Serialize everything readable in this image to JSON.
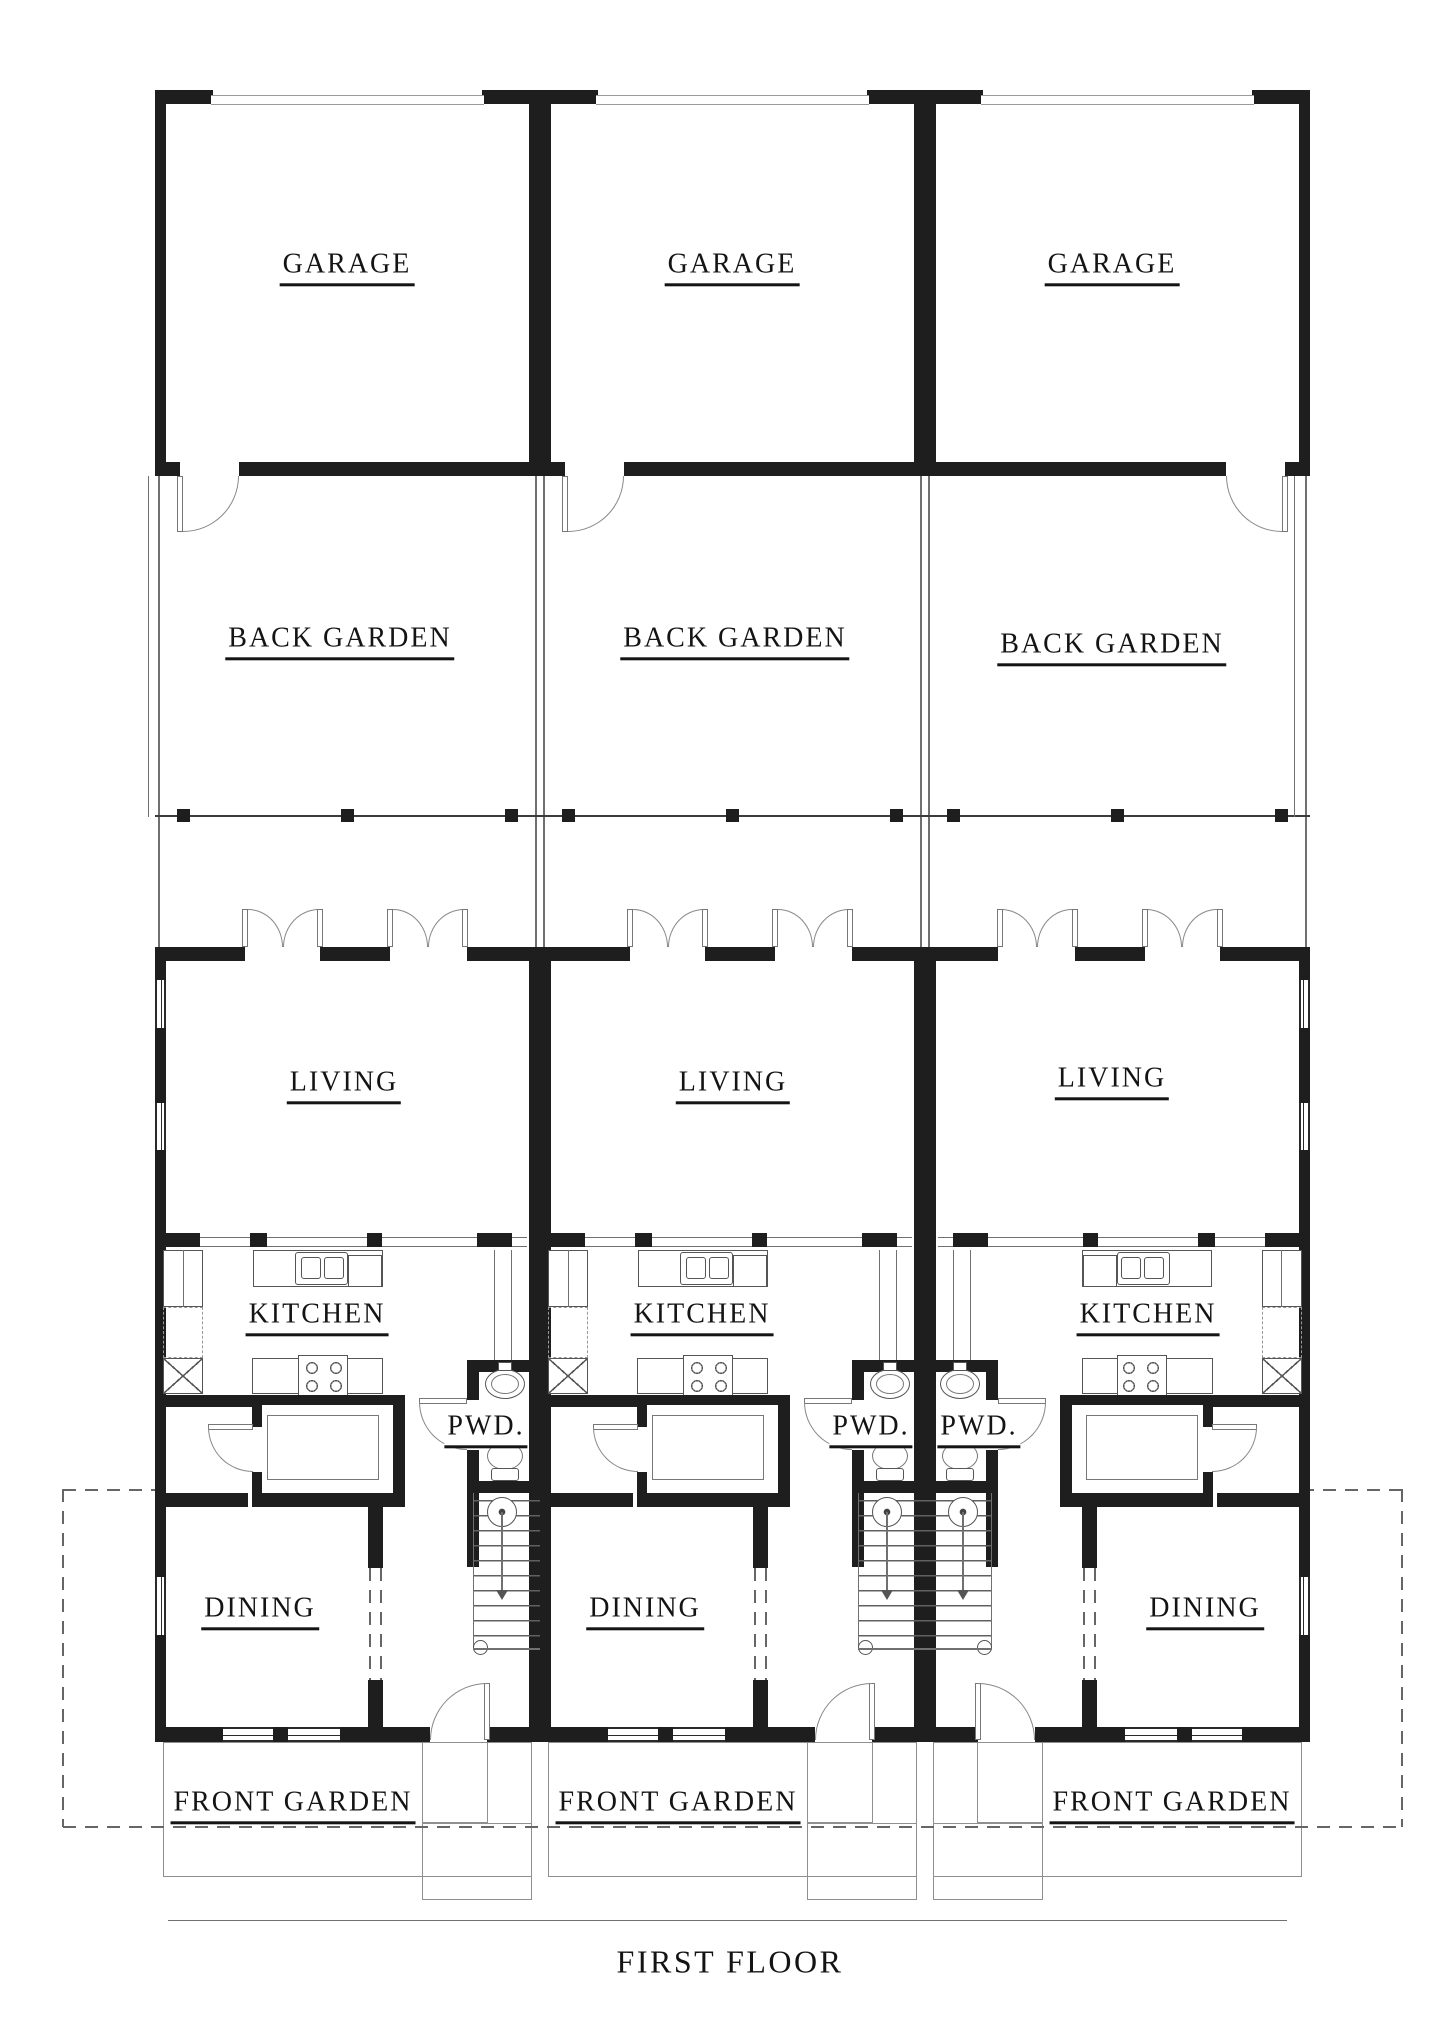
{
  "title": "FIRST FLOOR",
  "units": [
    {
      "id": "unit-1",
      "rooms": {
        "garage": "GARAGE",
        "back_garden": "BACK GARDEN",
        "living": "LIVING",
        "kitchen": "KITCHEN",
        "pwd": "PWD.",
        "dining": "DINING",
        "front_garden": "FRONT GARDEN"
      }
    },
    {
      "id": "unit-2",
      "rooms": {
        "garage": "GARAGE",
        "back_garden": "BACK GARDEN",
        "living": "LIVING",
        "kitchen": "KITCHEN",
        "pwd": "PWD.",
        "dining": "DINING",
        "front_garden": "FRONT GARDEN"
      }
    },
    {
      "id": "unit-3",
      "rooms": {
        "garage": "GARAGE",
        "back_garden": "BACK GARDEN",
        "living": "LIVING",
        "kitchen": "KITCHEN",
        "pwd": "PWD.",
        "dining": "DINING",
        "front_garden": "FRONT GARDEN"
      }
    }
  ],
  "colors": {
    "wall": "#1e1e1e",
    "thin_line": "#707070",
    "text": "#141414",
    "background": "#ffffff"
  }
}
